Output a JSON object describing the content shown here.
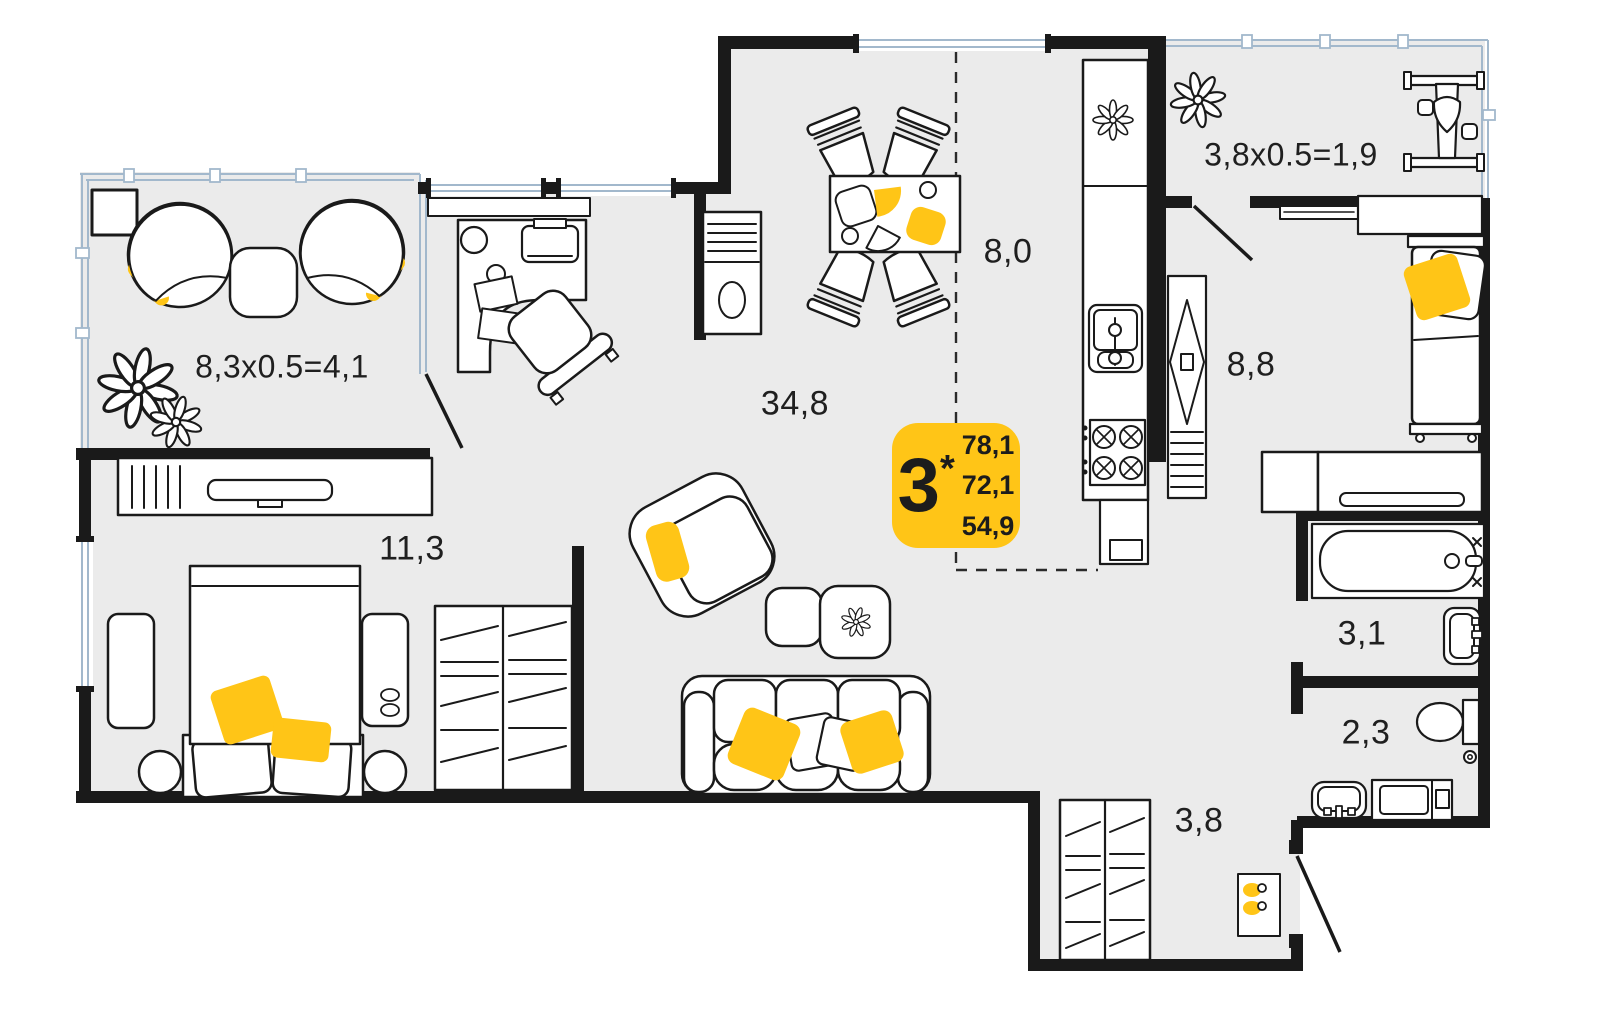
{
  "badge": {
    "rooms_count": "3",
    "asterisk": "*",
    "areas": [
      "78,1",
      "72,1",
      "54,9"
    ]
  },
  "room_labels": [
    {
      "room": "balcony-left",
      "label": "8,3x0.5=4,1"
    },
    {
      "room": "bedroom-left",
      "label": "11,3"
    },
    {
      "room": "living-room",
      "label": "34,8"
    },
    {
      "room": "kitchen",
      "label": "8,0"
    },
    {
      "room": "balcony-right",
      "label": "3,8x0.5=1,9"
    },
    {
      "room": "bedroom-right",
      "label": "8,8"
    },
    {
      "room": "bathroom",
      "label": "3,1"
    },
    {
      "room": "toilet",
      "label": "2,3"
    },
    {
      "room": "hallway",
      "label": "3,8"
    }
  ],
  "colors": {
    "floor": "#ebebeb",
    "walls": "#1a1a1a",
    "accent": "#ffc517",
    "glazing": "#a2b8cc",
    "text": "#1f1f1f"
  }
}
